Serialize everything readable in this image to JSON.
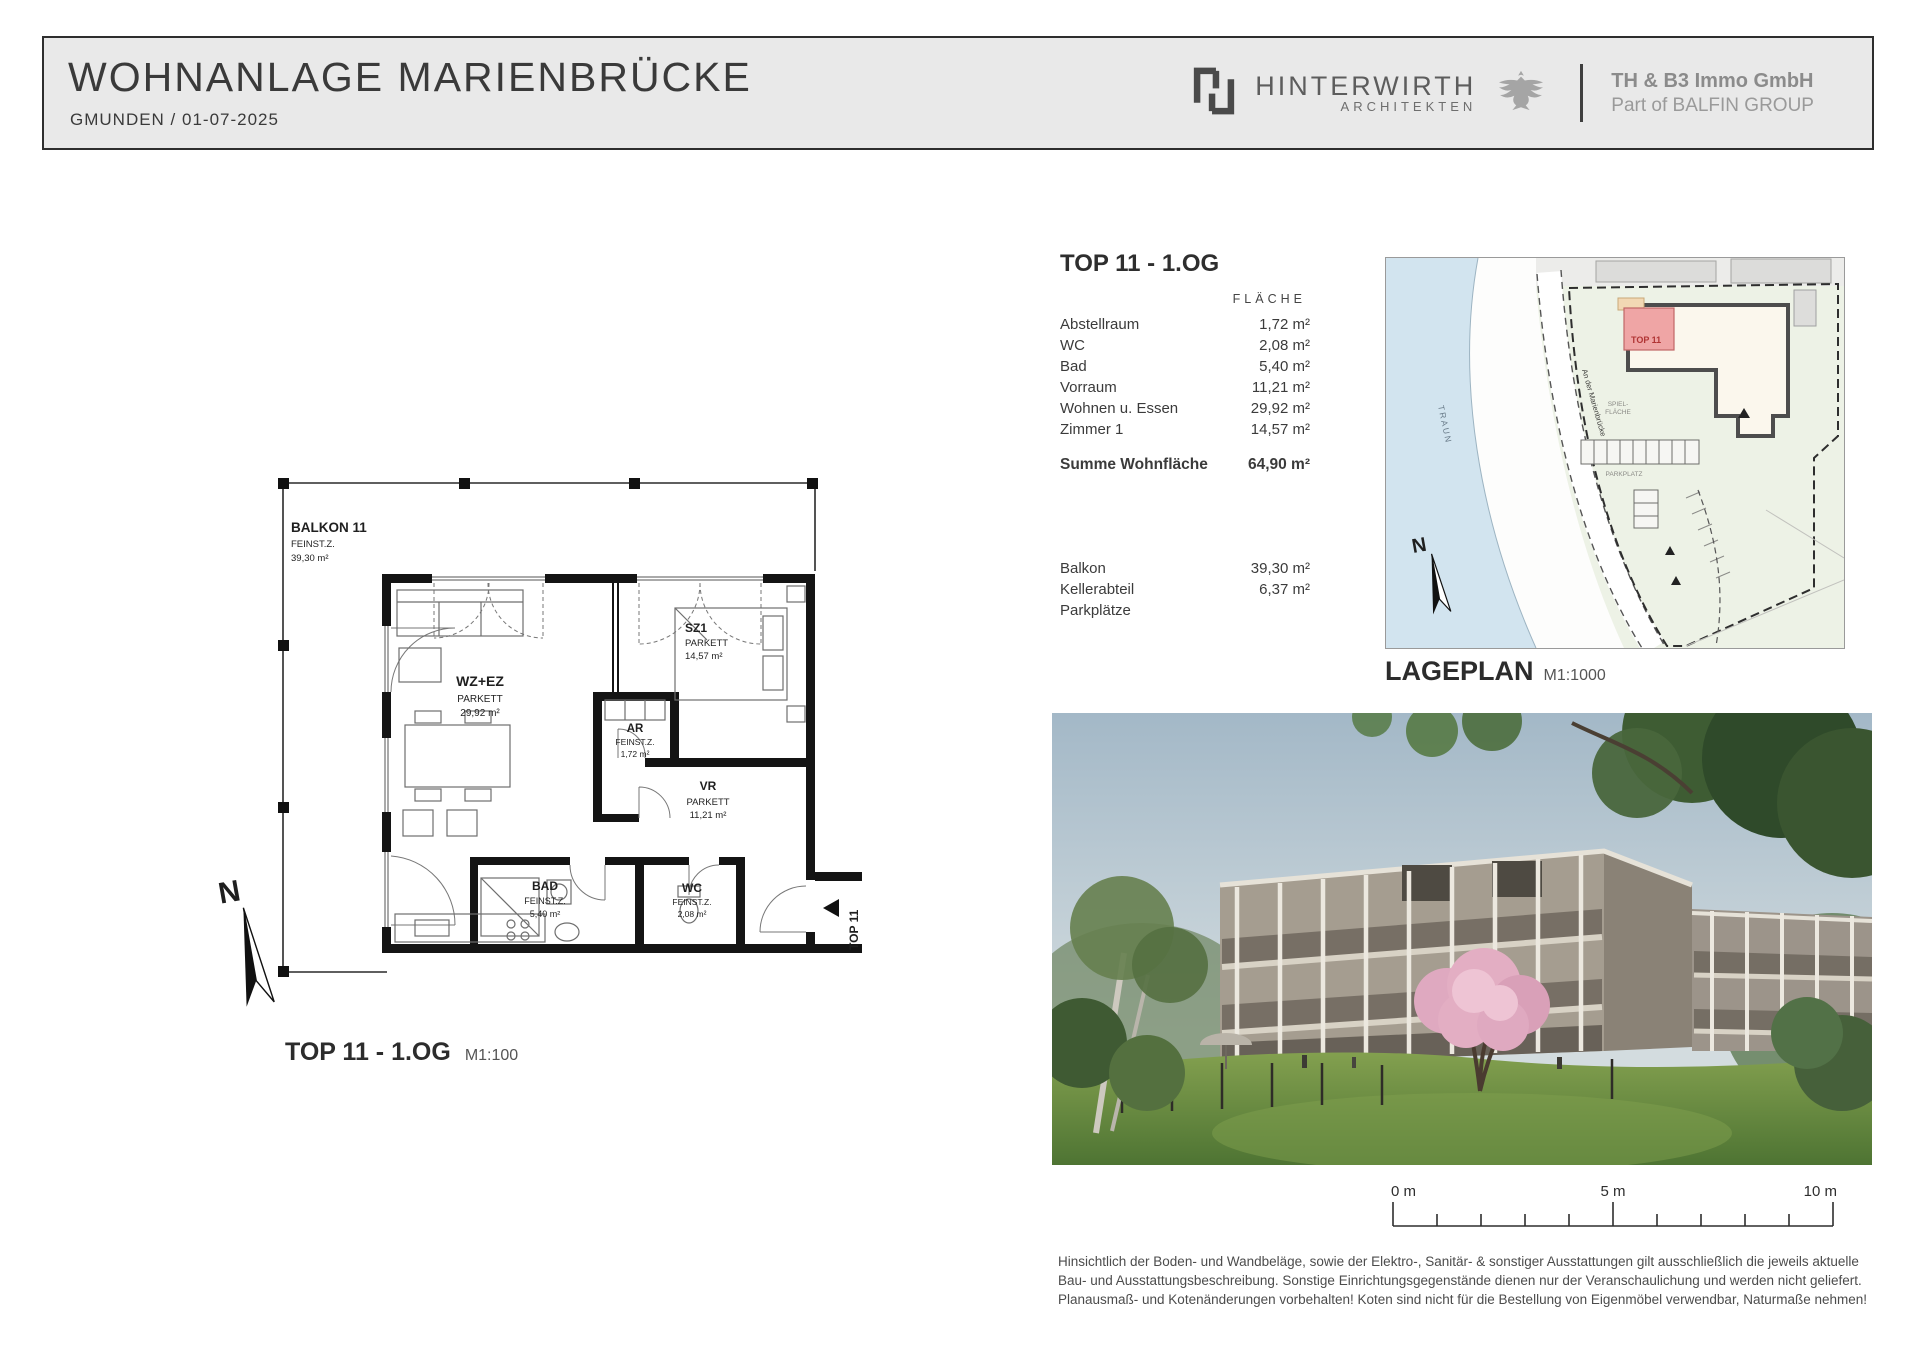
{
  "header": {
    "title": "WOHNANLAGE  MARIENBRÜCKE",
    "subtitle": "GMUNDEN  /  01-07-2025",
    "architect": {
      "name": "HINTERWIRTH",
      "sub": "ARCHITEKTEN"
    },
    "company": {
      "line1": "TH & B3 Immo GmbH",
      "line2": "Part of BALFIN GROUP"
    }
  },
  "unit_panel": {
    "title": "TOP 11 - 1.OG",
    "column_header": "FLÄCHE",
    "rows": [
      {
        "label": "Abstellraum",
        "value": "1,72 m²"
      },
      {
        "label": "WC",
        "value": "2,08 m²"
      },
      {
        "label": "Bad",
        "value": "5,40 m²"
      },
      {
        "label": "Vorraum",
        "value": "11,21 m²"
      },
      {
        "label": "Wohnen u. Essen",
        "value": "29,92 m²"
      },
      {
        "label": "Zimmer 1",
        "value": "14,57 m²"
      }
    ],
    "total": {
      "label": "Summe Wohnfläche",
      "value": "64,90 m²"
    },
    "extras": [
      {
        "label": "Balkon",
        "value": "39,30 m²"
      },
      {
        "label": "Kellerabteil",
        "value": "6,37 m²"
      },
      {
        "label": "Parkplätze",
        "value": ""
      }
    ]
  },
  "floor_plan": {
    "caption": "TOP 11   -   1.OG",
    "scale": "M1:100",
    "north_label": "N",
    "entry_label": "TOP 11",
    "rooms": {
      "balkon": {
        "name": "BALKON 11",
        "finish": "FEINST.Z.",
        "area": "39,30 m²"
      },
      "wz": {
        "name": "WZ+EZ",
        "finish": "PARKETT",
        "area": "29,92 m²"
      },
      "sz1": {
        "name": "SZ1",
        "finish": "PARKETT",
        "area": "14,57 m²"
      },
      "ar": {
        "name": "AR",
        "finish": "FEINST.Z.",
        "area": "1,72 m²"
      },
      "vr": {
        "name": "VR",
        "finish": "PARKETT",
        "area": "11,21 m²"
      },
      "bad": {
        "name": "BAD",
        "finish": "FEINST.Z.",
        "area": "5,40 m²"
      },
      "wc": {
        "name": "WC",
        "finish": "FEINST.Z.",
        "area": "2,08 m²"
      }
    }
  },
  "site_plan": {
    "caption": "LAGEPLAN",
    "scale": "M1:1000",
    "river_label": "TRAUN",
    "road_label": "An der Marienbrücke",
    "unit_label": "TOP 11",
    "play_area_line1": "SPIEL-",
    "play_area_line2": "FLÄCHE",
    "parking_label": "PARKPLATZ",
    "north_label": "N"
  },
  "scale_bar": {
    "start": "0 m",
    "mid": "5 m",
    "end": "10 m"
  },
  "disclaimer": {
    "line1": "Hinsichtlich der Boden- und Wandbeläge, sowie der Elektro-, Sanitär- & sonstiger Ausstattungen gilt ausschließlich die jeweils aktuelle",
    "line2": "Bau- und Ausstattungsbeschreibung. Sonstige Einrichtungsgegenstände dienen nur der Veranschaulichung und werden nicht geliefert.",
    "line3": "Planausmaß- und Kotenänderungen vorbehalten! Koten sind nicht für die Bestellung von Eigenmöbel verwendbar, Naturmaße nehmen!"
  },
  "colors": {
    "header_bg": "#e9e9e9",
    "unit_highlight_pink": "#efa5a5",
    "unit_label_red": "#b03434",
    "water_blue": "#d2e4ef",
    "site_green": "#edf2e6"
  }
}
